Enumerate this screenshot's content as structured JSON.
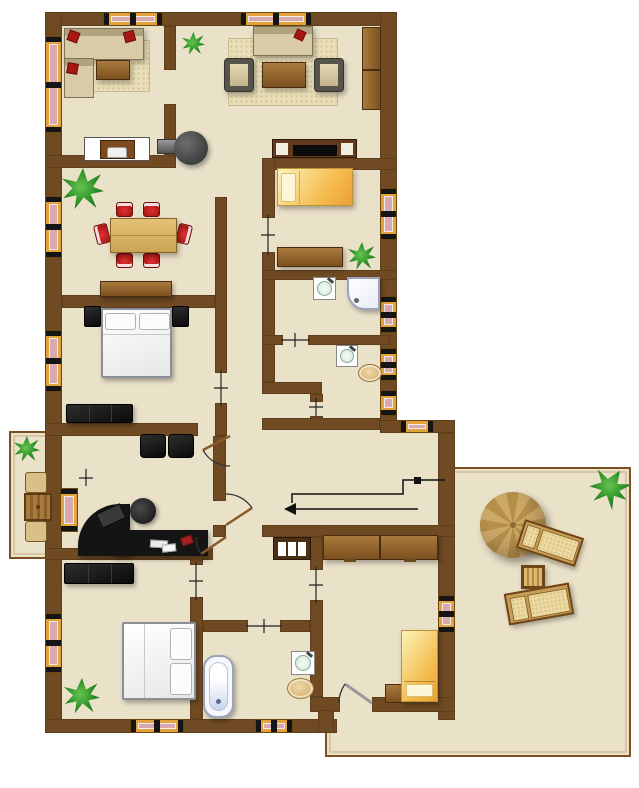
{
  "title": "apartment-floor-plan",
  "palette": {
    "wall": "#6F4A23",
    "floor": "#EAE1C9",
    "window_frame": "#E3A33C",
    "window_glass": "#D9A9B2",
    "wood": "#9A6A33",
    "chair_red": "#C01C1C",
    "plant_green": "#2F9427",
    "black_furniture": "#141414",
    "bed_yellow": "#F4BB4E",
    "outdoor_border": "#7D4F24"
  },
  "rooms": [
    {
      "name": "living-room-1",
      "furniture": [
        "corner-sofa",
        "coffee-table",
        "rug",
        "plant"
      ]
    },
    {
      "name": "living-room-2",
      "furniture": [
        "sofa",
        "armchair-left",
        "armchair-right",
        "coffee-table",
        "rug",
        "wardrobe",
        "tv-cabinet"
      ]
    },
    {
      "name": "dining-room",
      "furniture": [
        "dining-table",
        "six-red-chairs",
        "sideboard",
        "wood-stove",
        "plant",
        "dresser"
      ]
    },
    {
      "name": "bedroom-1",
      "furniture": [
        "double-bed",
        "nightstand-left",
        "nightstand-right",
        "black-wardrobe"
      ]
    },
    {
      "name": "bedroom-2",
      "furniture": [
        "single-bed-yellow",
        "dresser",
        "plant"
      ]
    },
    {
      "name": "bathroom-1",
      "furniture": [
        "sink",
        "shower"
      ]
    },
    {
      "name": "wc",
      "furniture": [
        "sink",
        "toilet"
      ]
    },
    {
      "name": "office",
      "furniture": [
        "corner-desk",
        "office-chair",
        "monitor",
        "keyboard",
        "visitor-chairs"
      ]
    },
    {
      "name": "bedroom-3",
      "furniture": [
        "double-bed",
        "black-wardrobe",
        "plant"
      ]
    },
    {
      "name": "bathroom-2",
      "furniture": [
        "bathtub",
        "sink",
        "toilet"
      ]
    },
    {
      "name": "bedroom-4",
      "furniture": [
        "single-bed-yellow",
        "nightstand",
        "wardrobe-counter"
      ]
    },
    {
      "name": "hallway",
      "furniture": [
        "entry-path-arrow",
        "shoe-rack"
      ]
    },
    {
      "name": "balcony",
      "furniture": [
        "table",
        "two-chairs",
        "plant"
      ]
    },
    {
      "name": "patio",
      "furniture": [
        "parasol",
        "sun-lounger-1",
        "sun-lounger-2",
        "side-table",
        "plant"
      ]
    }
  ],
  "counts": {
    "windows": 15,
    "door-arcs": 4,
    "door-thresholds": 8,
    "plants": 6
  }
}
